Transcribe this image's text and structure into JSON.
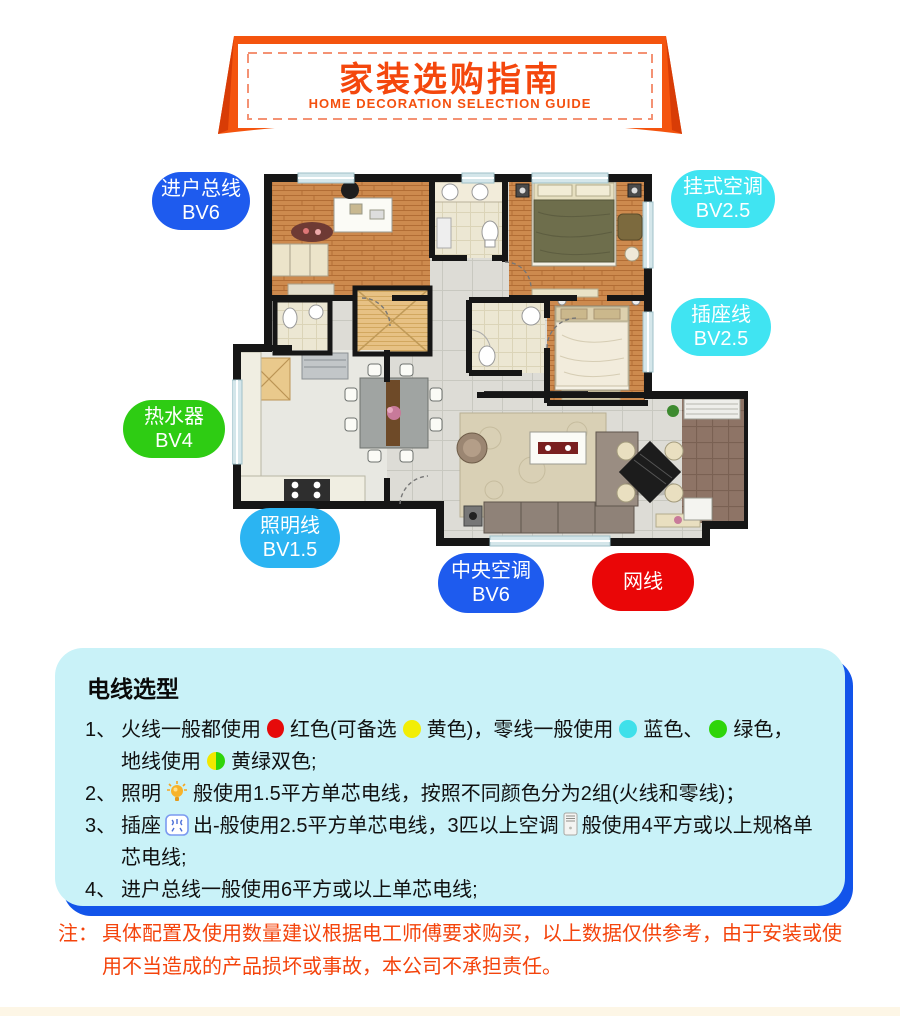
{
  "header": {
    "title": "家装选购指南",
    "subtitle": "HOME DECORATION SELECTION GUIDE"
  },
  "floorplan_labels": [
    {
      "id": "entry-main-line",
      "line1": "进户总线",
      "line2": "BV6",
      "color": "#1e5bee"
    },
    {
      "id": "wall-ac",
      "line1": "挂式空调",
      "line2": "BV2.5",
      "color": "#40e4f2"
    },
    {
      "id": "socket-line",
      "line1": "插座线",
      "line2": "BV2.5",
      "color": "#40e4f2"
    },
    {
      "id": "water-heater",
      "line1": "热水器",
      "line2": "BV4",
      "color": "#2ecc13"
    },
    {
      "id": "lighting-line",
      "line1": "照明线",
      "line2": "BV1.5",
      "color": "#2bb4f2"
    },
    {
      "id": "central-ac",
      "line1": "中央空调",
      "line2": "BV6",
      "color": "#1e5bee"
    },
    {
      "id": "network-cable",
      "line1": "网线",
      "line2": "",
      "color": "#ea0607"
    }
  ],
  "wire_guide": {
    "heading": "电线选型",
    "item1": {
      "num": "1、",
      "seg1": "火线一般都使用",
      "seg2": "红色(可备选",
      "seg3": "黄色)，零线一般使用",
      "seg4": "蓝色、",
      "seg5": "绿色，",
      "seg6": "地线使用",
      "seg7": "黄绿双色;"
    },
    "item2": {
      "num": "2、",
      "seg1": "照明",
      "seg2": "般使用1.5平方单芯电线，按照不同颜色分为2组(火线和零线)；"
    },
    "item3": {
      "num": "3、",
      "seg1": "插座",
      "seg2": "出-般使用2.5平方单芯电线，3匹以上空调",
      "seg3": "般使用4平方或以上规格单芯电线;"
    },
    "item4": {
      "num": "4、",
      "seg1": "进户总线一般使用6平方或以上单芯电线;"
    }
  },
  "note": {
    "prefix": "注：",
    "text": "具体配置及使用数量建议根据电工师傅要求购买，以上数据仅供参考，由于安装或使用不当造成的产品损坏或事故，本公司不承担责任。"
  },
  "colors": {
    "banner_orange": "#f4540e",
    "banner_text": "#f4470d",
    "box_fill": "#c9f2f8",
    "box_shadow_blue": "#1254ea",
    "note_red": "#f4440c"
  }
}
